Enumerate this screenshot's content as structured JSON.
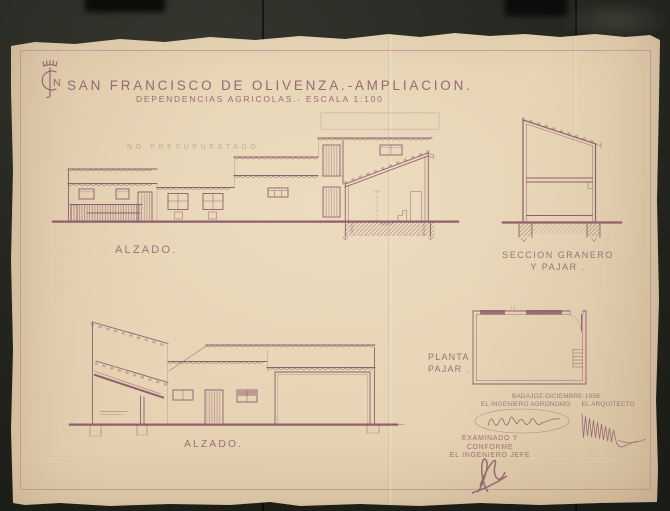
{
  "header": {
    "logo_letter": "N",
    "title": "SAN FRANCISCO DE OLIVENZA.-AMPLIACION.",
    "subtitle": "DEPENDENCIAS AGRICOLAS.- ESCALA 1:100"
  },
  "drawings": {
    "elevation_top": {
      "label": "ALZADO.",
      "annotation": "NO PRESUPUESTADO"
    },
    "section_granero": {
      "label_line1": "SECCION GRANERO",
      "label_line2": "Y PAJAR ."
    },
    "planta_pajar": {
      "label_line1": "PLANTA",
      "label_line2": "PAJAR ."
    },
    "elevation_bottom": {
      "label": "ALZADO."
    }
  },
  "title_block": {
    "place_date": "BADAJOZ-DICIEMBRE-1958",
    "signer_left_role": "EL INGENIERO AGRONOMO",
    "signer_right_role": "EL ARQUITECTO",
    "approval_line1": "EXAMINADO Y CONFORME",
    "approval_role": "EL INGENIERO JEFE"
  },
  "colors": {
    "backdrop": "#24251f",
    "paper": "#e5d1b0",
    "ink": "#8e5f6e",
    "ink_light": "#ab8793",
    "border": "#bb8a9b"
  }
}
